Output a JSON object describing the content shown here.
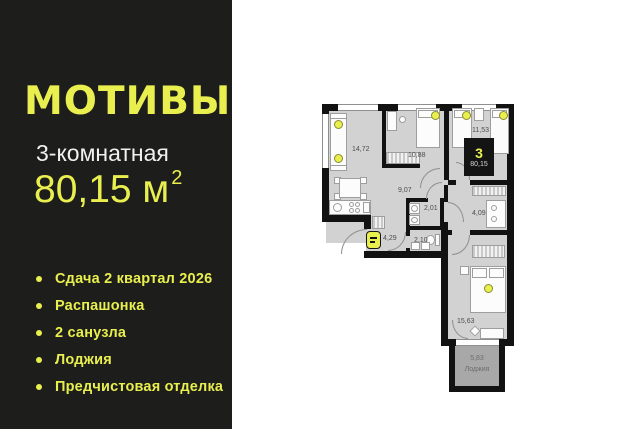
{
  "brand": {
    "name": "МОТИВЫ"
  },
  "listing": {
    "type": "3-комнатная",
    "area": "80,15 м",
    "area_sup": "2"
  },
  "features": [
    {
      "label": "Сдача 2 квартал 2026"
    },
    {
      "label": "Распашонка"
    },
    {
      "label": "2 санузла"
    },
    {
      "label": "Лоджия"
    },
    {
      "label": "Предчистовая отделка"
    }
  ],
  "floorplan": {
    "badge": {
      "rooms": "3",
      "area": "80,15"
    },
    "rooms": [
      {
        "id": "kitchen-living",
        "area": "14,72"
      },
      {
        "id": "bedroom-1",
        "area": "10,88"
      },
      {
        "id": "bedroom-2",
        "area": "11,53"
      },
      {
        "id": "corridor",
        "area": "9,07"
      },
      {
        "id": "bathroom-1",
        "area": "2,01"
      },
      {
        "id": "hallway",
        "area": "4,09"
      },
      {
        "id": "entry",
        "area": "4,29"
      },
      {
        "id": "bathroom-2",
        "area": "2,10"
      },
      {
        "id": "bedroom-3",
        "area": "15,63"
      },
      {
        "id": "loggia",
        "area": "5,83",
        "name": "Лоджия"
      }
    ],
    "icons": {
      "entrance_marker": "entrance-key-icon",
      "bed_marker": "yellow-socket-dot"
    }
  },
  "colors": {
    "accent": "#e9ef4e",
    "panel_bg": "#1d1d1b",
    "text_light": "#f1f1ee",
    "wall": "#121212",
    "floor": "#d2d2d2",
    "loggia_floor": "#a8a8a8"
  }
}
